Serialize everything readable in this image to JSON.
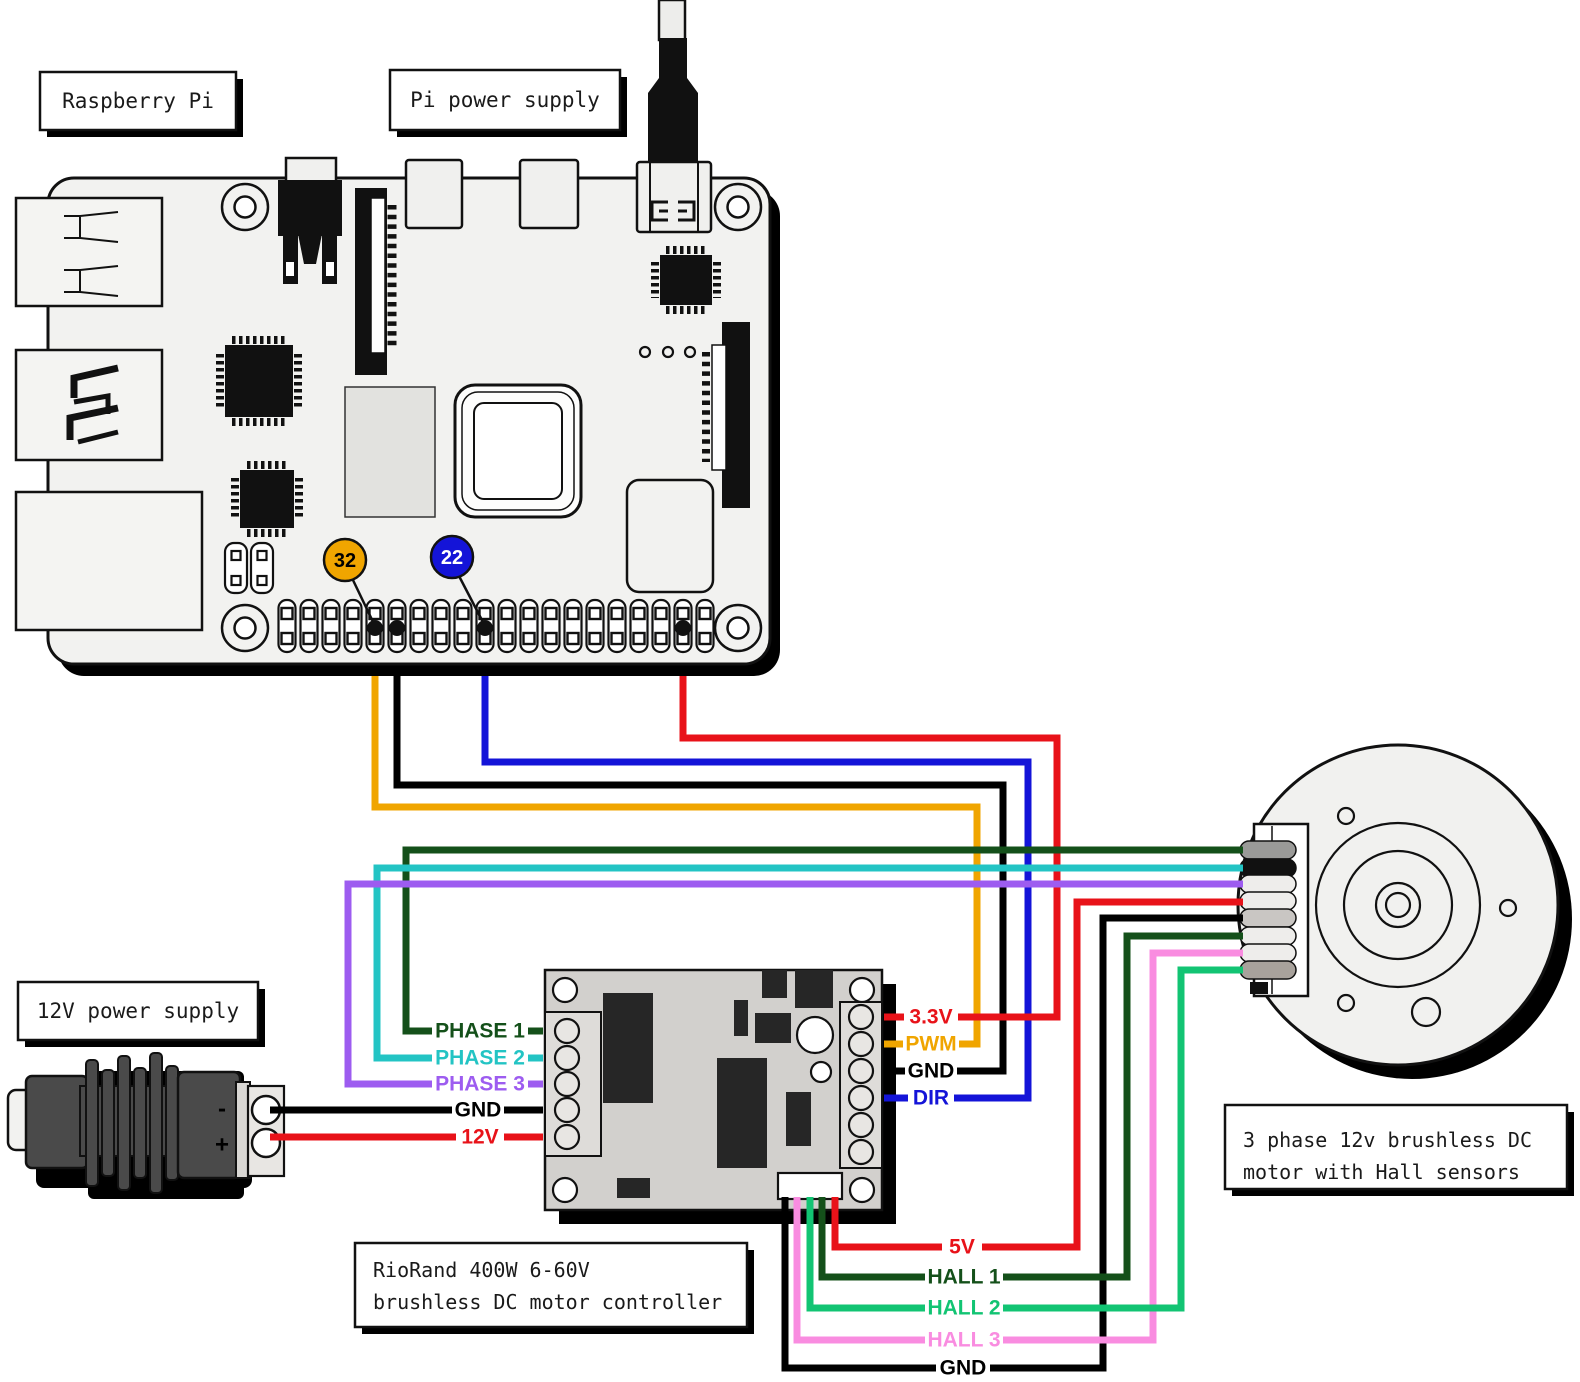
{
  "page": {
    "background": "#ffffff"
  },
  "colors": {
    "gold": "#f0a500",
    "blue": "#1414d8",
    "red": "#e81219",
    "black": "#000000",
    "dark_green": "#14501a",
    "cyan": "#23c4c4",
    "purple": "#9d5cf0",
    "pink": "#f98ce0",
    "green": "#12c473"
  },
  "labels": {
    "raspberry_pi": "Raspberry Pi",
    "pi_power_supply": "Pi power supply",
    "dc_power_supply": "12V power supply",
    "controller_line1": "RioRand 400W 6-60V",
    "controller_line2": "brushless DC motor controller",
    "motor_line1": "3 phase 12v brushless DC",
    "motor_line2": "motor with Hall sensors"
  },
  "gpio_badges": [
    {
      "label": "32",
      "fill": "#f0a500",
      "text_color": "#000000"
    },
    {
      "label": "22",
      "fill": "#1414d8",
      "text_color": "#ffffff"
    }
  ],
  "controller": {
    "left_terminals": [
      {
        "label": "PHASE 1",
        "color": "#14501a"
      },
      {
        "label": "PHASE 2",
        "color": "#23c4c4"
      },
      {
        "label": "PHASE 3",
        "color": "#9d5cf0"
      },
      {
        "label": "GND",
        "color": "#000000"
      },
      {
        "label": "12V",
        "color": "#e81219"
      }
    ],
    "right_terminals": [
      {
        "label": "3.3V",
        "color": "#e81219"
      },
      {
        "label": "PWM",
        "color": "#f0a500"
      },
      {
        "label": "GND",
        "color": "#000000"
      },
      {
        "label": "DIR",
        "color": "#1414d8"
      }
    ],
    "bottom_wires": [
      {
        "label": "5V",
        "color": "#e81219"
      },
      {
        "label": "HALL 1",
        "color": "#14501a"
      },
      {
        "label": "HALL 2",
        "color": "#12c473"
      },
      {
        "label": "HALL 3",
        "color": "#f98ce0"
      },
      {
        "label": "GND",
        "color": "#000000"
      }
    ]
  },
  "power_supply": {
    "negative_label": "-",
    "positive_label": "+"
  }
}
